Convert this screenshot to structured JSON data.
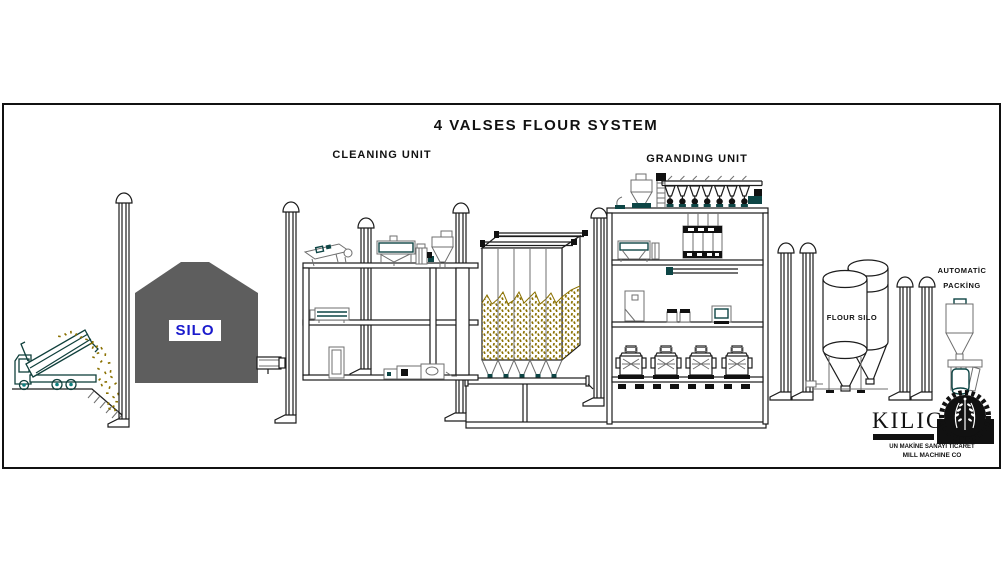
{
  "title": "4 VALSES FLOUR SYSTEM",
  "labels": {
    "cleaning_unit": "CLEANING UNIT",
    "granding_unit": "GRANDING UNIT",
    "silo": "SILO",
    "flour_silo": "FLOUR SILO",
    "packing_line1": "AUTOMATİC",
    "packing_line2": "PACKİNG"
  },
  "logo": {
    "brand": "KILIC",
    "subline1": "UN MAKİNE SANAYİ TİCARET",
    "subline2": "MILL MACHINE CO"
  },
  "colors": {
    "outline": "#1c1c1c",
    "machine_gray": "#6f6f6f",
    "machine_teal": "#0d4545",
    "grain": "#8a7000",
    "silo_fill": "#5e5e5e",
    "silo_label_text": "#1a1acc",
    "truck_window": "#a8dcee"
  },
  "equipment_icons": [
    "dump-truck",
    "intake-pit",
    "wheat-silo",
    "vent-pipe",
    "cleaning-building",
    "tempering-bin",
    "granding-building",
    "roller-mill",
    "flour-silo-tanks",
    "packing-machine",
    "gear-wheat-emblem"
  ]
}
